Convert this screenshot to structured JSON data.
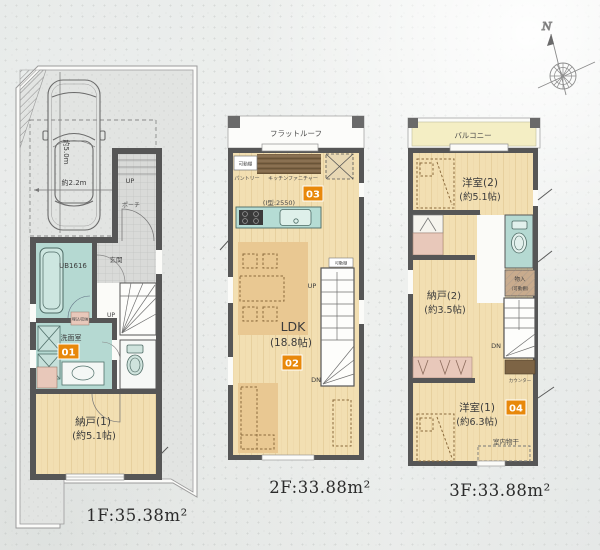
{
  "colors": {
    "badge": "#e8880a",
    "wall": "#565656",
    "teal": "#b5d9d2",
    "wood": "#f2dfb2",
    "rug": "#e9c892",
    "pink": "#e8c8ba",
    "balcony_yellow": "#f4eec4",
    "brown": "#7d6445"
  },
  "compass": {
    "north_label": "N"
  },
  "floor1": {
    "area_label": "1F:35.38m²",
    "car_length": "約5.0m",
    "car_width": "約2.2m",
    "approach_up": "UP",
    "porch": "ポーチ",
    "entrance": "玄関",
    "unit_bath": "UB1616",
    "recessed_storage": "埋込収納",
    "washroom": "洗面室",
    "badge": "01",
    "vanity_width": "W900",
    "stairs_up": "UP",
    "storage_room": "納戸(1)",
    "storage_room_size": "(約5.1帖)"
  },
  "floor2": {
    "area_label": "2F:33.88m²",
    "flat_roof": "フラットルーフ",
    "movable_shelf": "可動棚",
    "pantry": "パントリー",
    "kitchen_furniture": "キッチンファニチャー",
    "kitchen_badge": "03",
    "kitchen_type": "(I型:2550)",
    "ldk": "LDK",
    "ldk_size": "(18.8帖)",
    "ldk_badge": "02",
    "stairs_up": "UP",
    "stairs_shelf": "可動棚",
    "stairs_down": "DN"
  },
  "floor3": {
    "area_label": "3F:33.88m²",
    "balcony": "バルコニー",
    "bedroom2": "洋室(2)",
    "bedroom2_size": "(約5.1帖)",
    "closet": "物入",
    "closet_shelf": "(可動棚)",
    "storage_room": "納戸(2)",
    "storage_room_size": "(約3.5帖)",
    "stairs_down": "DN",
    "counter": "カウンター",
    "bedroom1": "洋室(1)",
    "bedroom1_size": "(約6.3帖)",
    "badge": "04",
    "indoor_drying": "室内物干"
  }
}
